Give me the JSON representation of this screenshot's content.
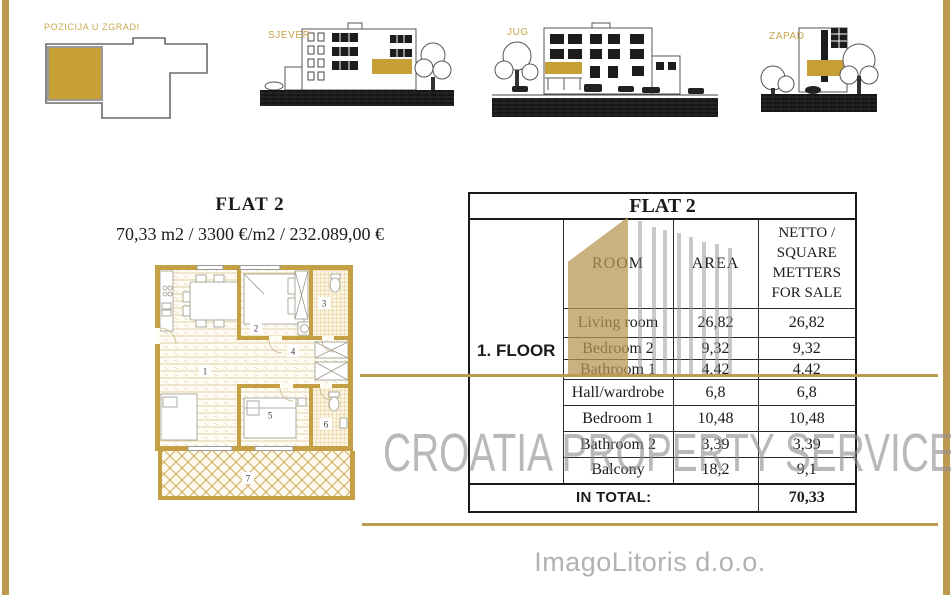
{
  "page": {
    "background": "#ffffff",
    "accent_gold": "#c6a035",
    "frame_gold": "#bd9a52",
    "watermark_gray": "#8f8f8f"
  },
  "thumbnails": {
    "position": {
      "label": "POZICIJA U ZGRADI"
    },
    "north": {
      "label": "SJEVER"
    },
    "south": {
      "label": "JUG"
    },
    "west": {
      "label": "ZAPAD"
    }
  },
  "flat": {
    "title": "FLAT 2",
    "subtitle": "70,33 m2 / 3300 €/m2 / 232.089,00 €"
  },
  "plan": {
    "rooms": [
      "1",
      "2",
      "3",
      "4",
      "5",
      "6",
      "7"
    ]
  },
  "table": {
    "title": "FLAT 2",
    "floor_label": "1. FLOOR",
    "col_room": "ROOM",
    "col_area": "AREA",
    "col_netto": "NETTO / SQUARE METTERS FOR SALE",
    "rows": [
      {
        "room": "Living room",
        "area": "26,82",
        "netto": "26,82"
      },
      {
        "room": "Bedroom 2",
        "area": "9,32",
        "netto": "9,32"
      },
      {
        "room": "Bathroom 1",
        "area": "4,42",
        "netto": "4,42"
      },
      {
        "room": "Hall/wardrobe",
        "area": "6,8",
        "netto": "6,8"
      },
      {
        "room": "Bedroom 1",
        "area": "10,48",
        "netto": "10,48"
      },
      {
        "room": "Bathroom 2",
        "area": "3,39",
        "netto": "3,39"
      },
      {
        "room": "Balcony",
        "area": "18,2",
        "netto": "9,1"
      }
    ],
    "total_label": "IN TOTAL:",
    "total_value": "70,33"
  },
  "watermark": {
    "text": "CROATIA PROPERTY SERVICE"
  },
  "footer": {
    "company": "ImagoLitoris d.o.o."
  }
}
